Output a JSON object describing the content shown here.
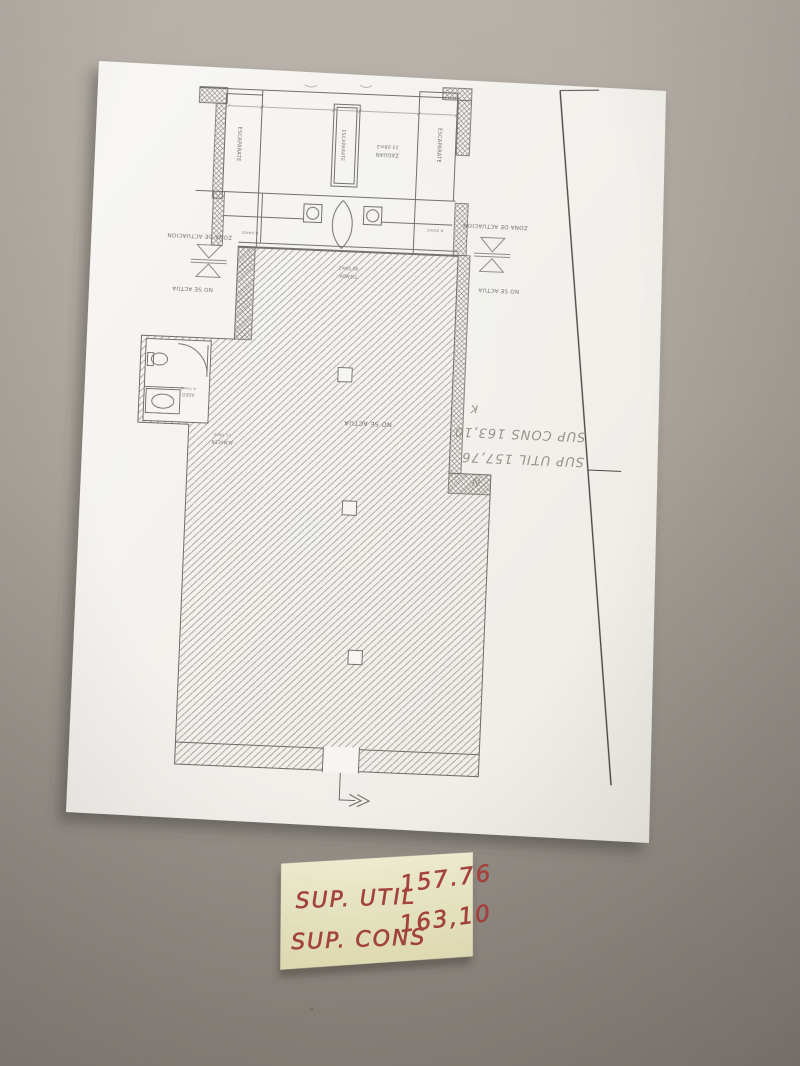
{
  "photo": {
    "surface_color_top": "#b8b2aa",
    "surface_color_bottom": "#8a837c",
    "paper_color": "#f6f5f1"
  },
  "plan": {
    "line_color": "#6e6a66",
    "orientation": "rotated-180",
    "labels": {
      "escaparate": "ESCAPARATE",
      "zaguan": "ZAGUAN",
      "zaguan_area": "23.08m2",
      "zona_actuacion": "ZONA DE ACTUACION",
      "no_se_actua": "NO SE ACTUA",
      "tienda": "TIENDA",
      "tienda_area": "40.50m2",
      "aseo": "ASEO",
      "aseo_area": "4.70m2",
      "almacen": "ALMACEN",
      "almacen_area": "17.19m2",
      "area_small_left": "8.04m2",
      "area_small_right": "6.30m2"
    },
    "pencil_notes": {
      "color": "#96908a",
      "line_util": "SUP UTIL  157,76",
      "line_cons": "SUP CONS  163,10",
      "mark_top": "K",
      "mark_bottom": "N"
    }
  },
  "sticky_note": {
    "paper_color": "#eeeac8",
    "ink_color": "#a8453f",
    "line1_label": "SUP. UTIL",
    "line1_value": "157.76",
    "line2_label": "SUP. CONS",
    "line2_value": "163,10"
  }
}
